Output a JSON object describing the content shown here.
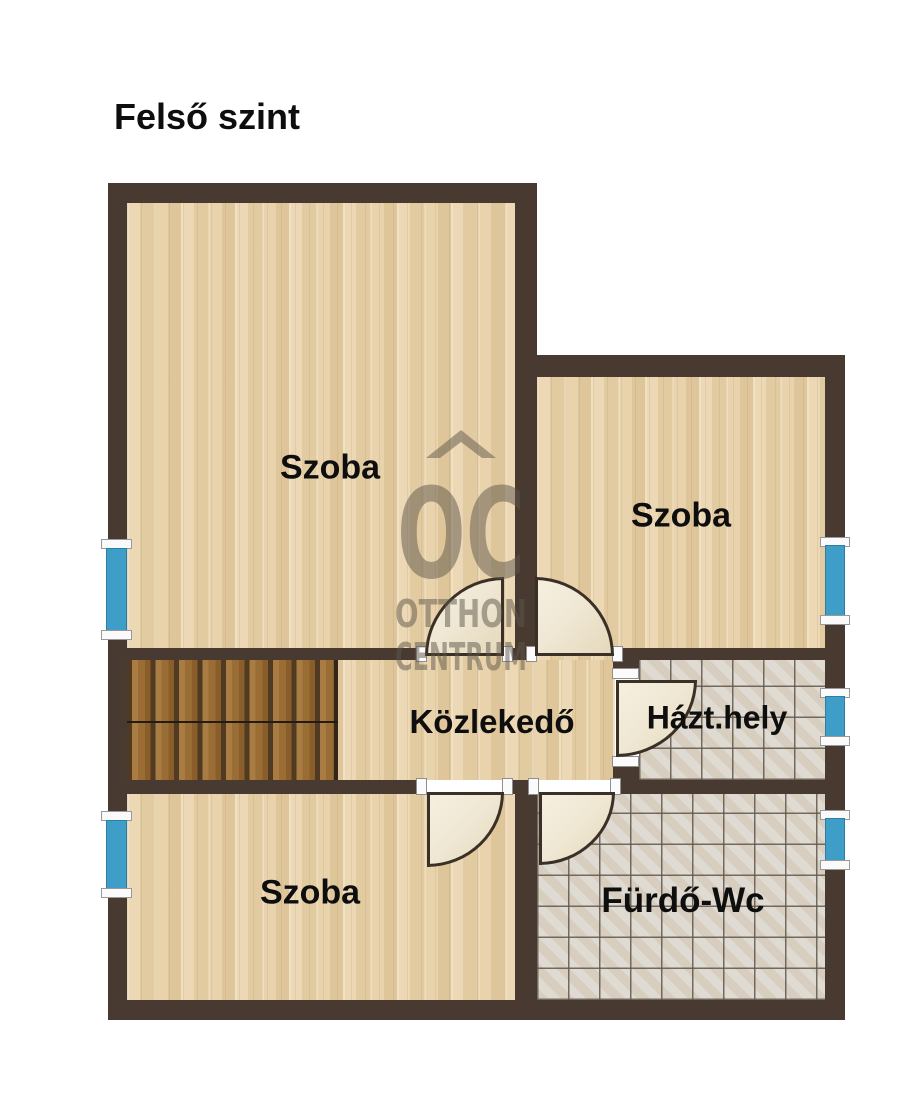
{
  "page": {
    "title": "Felső szint"
  },
  "floorplan": {
    "rooms": [
      {
        "key": "szoba_main",
        "label": "Szoba"
      },
      {
        "key": "szoba_right",
        "label": "Szoba"
      },
      {
        "key": "kozlekedo",
        "label": "Közlekedő"
      },
      {
        "key": "hazt_hely",
        "label": "Házt.hely"
      },
      {
        "key": "szoba_bottom",
        "label": "Szoba"
      },
      {
        "key": "furdo_wc",
        "label": "Fürdő-Wc"
      }
    ],
    "watermark": {
      "logo": "OC",
      "line1": "OTTHON",
      "line2": "CENTRUM"
    }
  },
  "colors": {
    "wall": "#483a30",
    "wood_floor": "#e7d1ab",
    "tile_floor": "#d8d2c8",
    "stair_tread": "#9a6d35",
    "stair_gap": "#503a21",
    "window_blue": "#3f9ec8",
    "window_cap": "#fafafa",
    "door_leaf": "#f0e8d5",
    "door_outline": "#3a3026",
    "watermark_grey": "#5f574a",
    "label_text": "#0e0e0e"
  }
}
